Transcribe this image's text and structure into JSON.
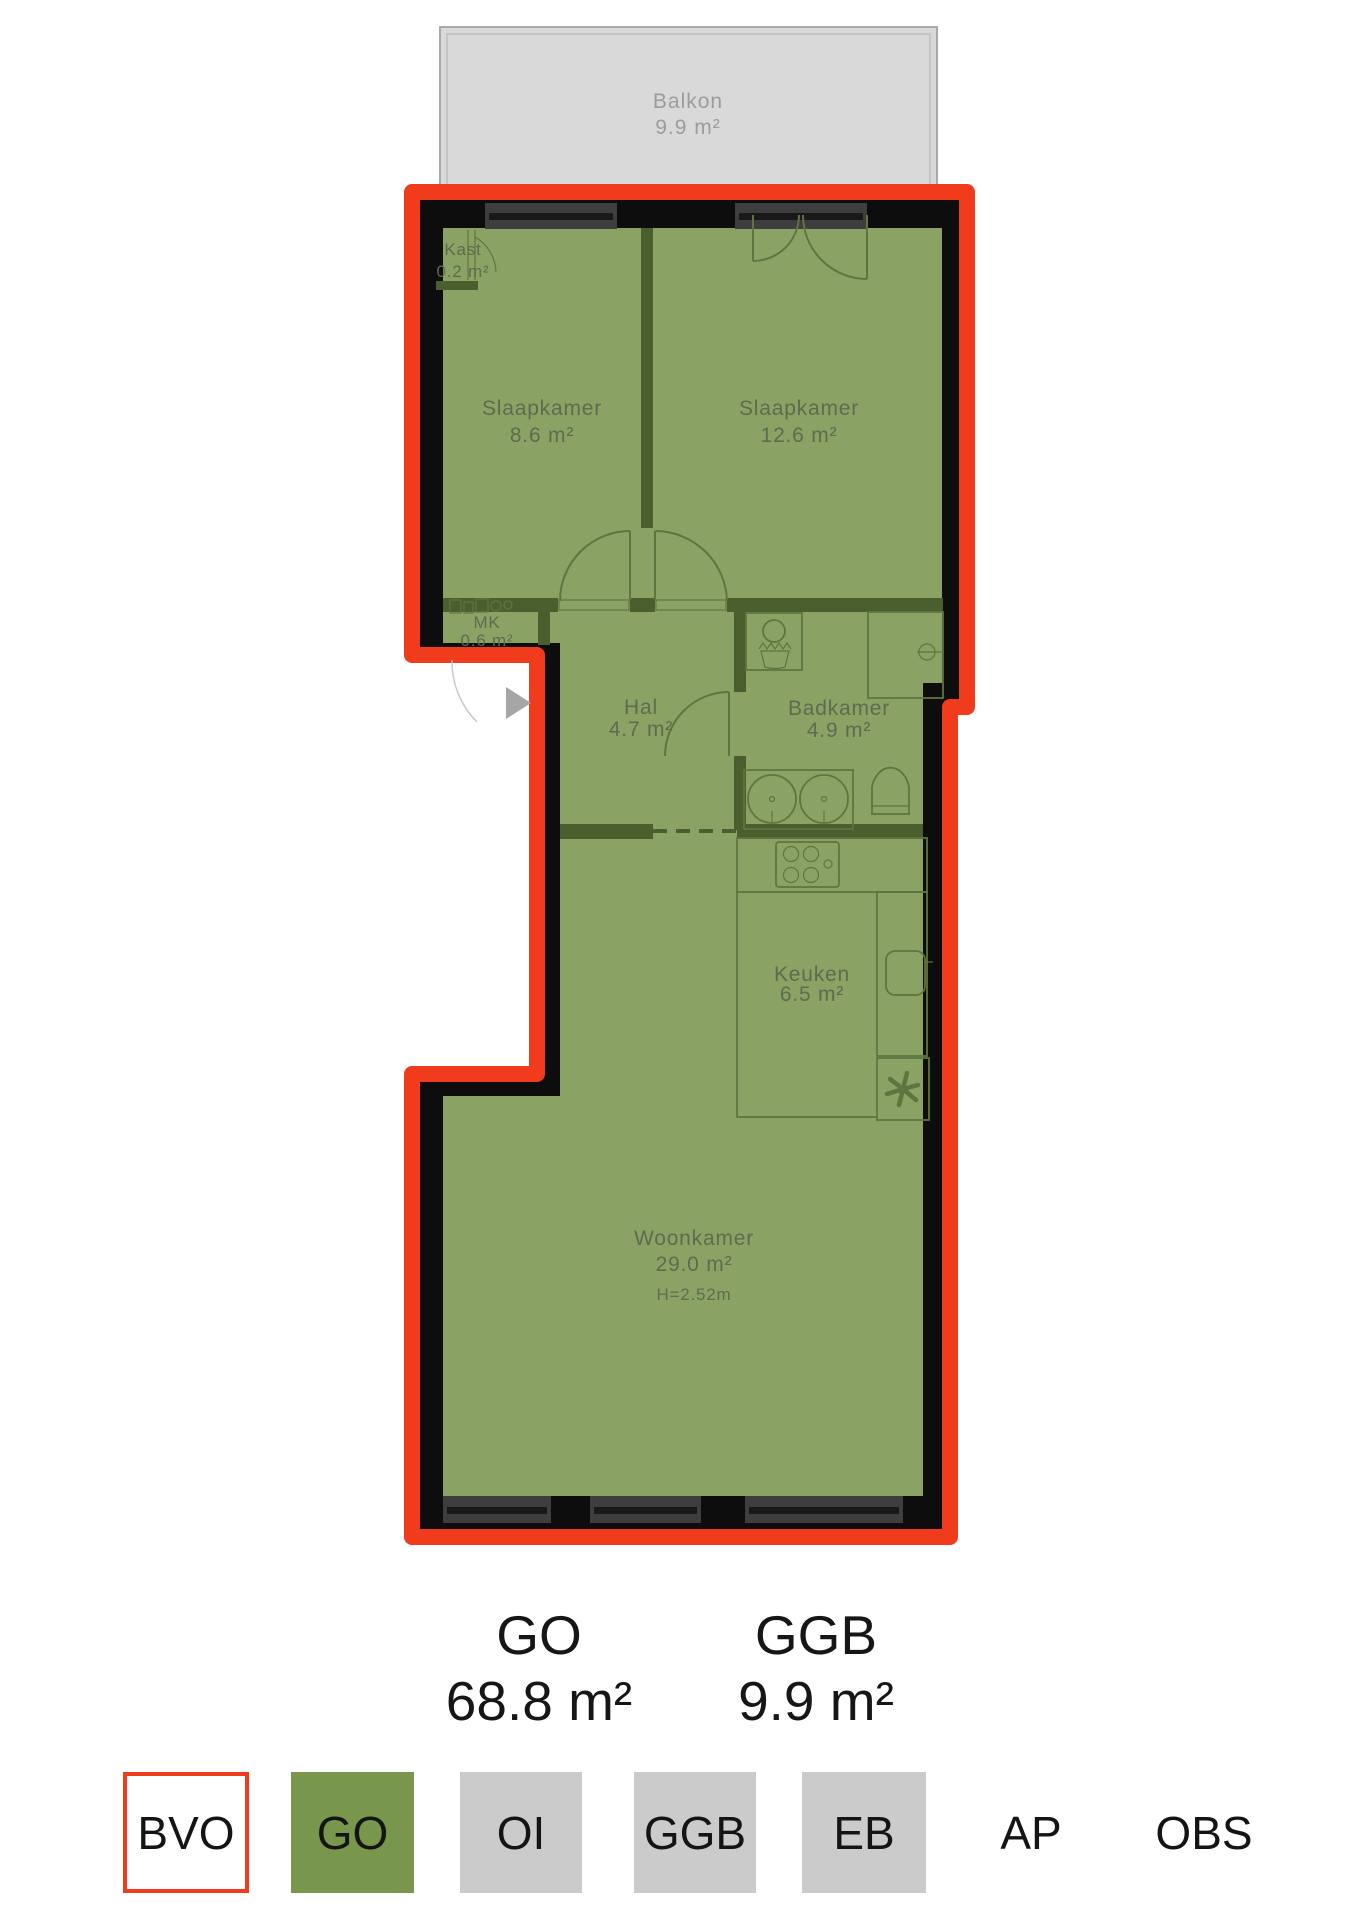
{
  "colors": {
    "bvo_outline_red": "#f03b1d",
    "go_fill_green": "#78974c",
    "floor_overlay_green": "#8aa365",
    "interior_wall_olive": "#4a5f2d",
    "legend_grey": "#cbcbcb",
    "balcony_grey": "#d9d9d9",
    "wall_black": "#0d0d0d"
  },
  "floorplan": {
    "balcony": {
      "name": "Balkon",
      "area": "9.9 m²"
    },
    "rooms": [
      {
        "name": "Kast",
        "area": "0.2 m²"
      },
      {
        "name": "Slaapkamer",
        "area": "8.6 m²"
      },
      {
        "name": "Slaapkamer",
        "area": "12.6 m²"
      },
      {
        "name": "MK",
        "area": "0.6 m²"
      },
      {
        "name": "Hal",
        "area": "4.7 m²"
      },
      {
        "name": "Badkamer",
        "area": "4.9 m²"
      },
      {
        "name": "Keuken",
        "area": "6.5 m²"
      },
      {
        "name": "Woonkamer",
        "area": "29.0 m²",
        "ceiling_height": "H=2.52m"
      }
    ]
  },
  "summary": {
    "go": {
      "label": "GO",
      "value": "68.8 m²"
    },
    "ggb": {
      "label": "GGB",
      "value": "9.9 m²"
    }
  },
  "legend": {
    "items": [
      {
        "label": "BVO"
      },
      {
        "label": "GO"
      },
      {
        "label": "OI"
      },
      {
        "label": "GGB"
      },
      {
        "label": "EB"
      },
      {
        "label": "AP"
      },
      {
        "label": "OBS"
      }
    ]
  }
}
